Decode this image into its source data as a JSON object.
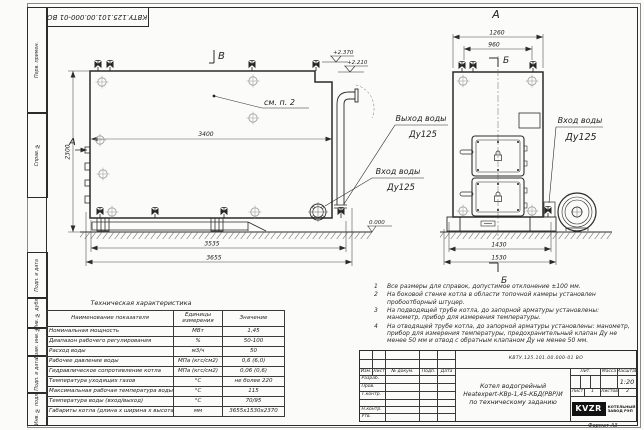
{
  "sheet": {
    "stamp_doc_number": "КВТУ.125.101.00.000-01 ВО",
    "format_note": "Формат А3",
    "margin_boxes": [
      {
        "label": "Перв. примен."
      },
      {
        "label": "Справ. №"
      },
      {
        "label": "Подп. и дата"
      },
      {
        "label": "Инв. № дубл."
      },
      {
        "label": "Взам. инв. №"
      },
      {
        "label": "Подп. и дата"
      },
      {
        "label": "Инв. № подл."
      }
    ]
  },
  "side_view": {
    "flag_label": "В",
    "view_arrow_label": "А",
    "see_note": "см. п. 2",
    "dim_length_mid": "3400",
    "dim_height": "2300",
    "dim_base": "3535",
    "dim_overall": "3655",
    "elev_top": "+2.370",
    "elev_step": "+2.210",
    "elev_zero": "0.000",
    "outlet_label": "Выход воды",
    "outlet_dn": "Ду125",
    "inlet_label": "Вход воды",
    "inlet_dn": "Ду125"
  },
  "front_view": {
    "title": "А",
    "section_top": "Б",
    "section_bottom": "Б",
    "dim_width": "1260",
    "dim_inner": "960",
    "dim_base": "1430",
    "dim_base_outer": "1530",
    "inlet_label": "Вход воды",
    "inlet_dn": "Ду125"
  },
  "tech_table": {
    "title": "Техническая характеристика",
    "col_name": "Наименование показателя",
    "col_units": "Единицы измерения",
    "col_value": "Значение",
    "rows": [
      {
        "name": "Номинальная мощность",
        "units": "МВт",
        "value": "1,45"
      },
      {
        "name": "Диапазон рабочего регулирования",
        "units": "%",
        "value": "50-100"
      },
      {
        "name": "Расход воды",
        "units": "м3/ч",
        "value": "50"
      },
      {
        "name": "Рабочее давление воды",
        "units": "МПа (кгс/см2)",
        "value": "0,6 (6,0)"
      },
      {
        "name": "Гидравлическое сопротивление котла",
        "units": "МПа (кгс/см2)",
        "value": "0,06 (0,6)"
      },
      {
        "name": "Температура уходящих газов",
        "units": "°С",
        "value": "не более 220"
      },
      {
        "name": "Максимальная рабочая температура воды",
        "units": "°С",
        "value": "115"
      },
      {
        "name": "Температура воды (вход/выход)",
        "units": "°С",
        "value": "70/95"
      },
      {
        "name": "Габариты котла (длина х ширина х высота)",
        "units": "мм",
        "value": "3655х1530х2370"
      }
    ]
  },
  "notes": {
    "items": [
      {
        "num": "1",
        "text": "Все размеры для справок, допустимое отклонение ±100 мм."
      },
      {
        "num": "2",
        "text": "На боковой стенке котла в области топочной камеры установлен пробоотборный штуцер."
      },
      {
        "num": "3",
        "text": "На подводящей трубе котла, до запорной арматуры установлены: манометр, прибор для измерения температуры."
      },
      {
        "num": "4",
        "text": "На отводящей трубе котла, до запорной арматуры установлены: манометр, прибор для измерения температуры, предохранительный клапан Ду не менее 50 мм и отвод с обратным клапаном Ду не менее 50 мм."
      }
    ]
  },
  "title_block": {
    "doc_number": "КВТУ.125.101.00.000-01 ВО",
    "name_line1": "Котел водогрейный",
    "name_line2": "Heatexpert-КВр-1,45-КБД(РВР)И",
    "name_line3": "по техническому заданию",
    "col_izm": "Изм.",
    "col_list": "Лист",
    "col_doc": "№ докум.",
    "col_podp": "Подп.",
    "col_data": "Дата",
    "row_razrab": "Разраб.",
    "row_prov": "Пров.",
    "row_tkontr": "Т.контр.",
    "row_nkontr": "Н.контр.",
    "row_utv": "Утв.",
    "lit_label": "Лит.",
    "massa_label": "Масса",
    "masshtab_label": "Масштаб",
    "scale": "1:20",
    "sheet_label": "Лист",
    "sheet_num": "1",
    "sheets_label": "Листов",
    "sheets_num": "2",
    "logo_text": "KVZR",
    "logo_sub1": "КОТЕЛЬНЫЙ",
    "logo_sub2": "ЗАВОД РЭП"
  }
}
